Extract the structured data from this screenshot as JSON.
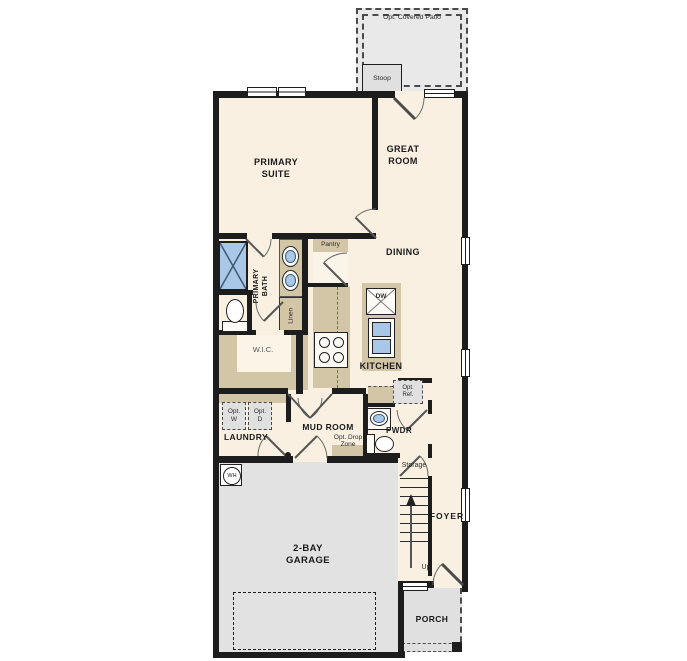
{
  "plan": {
    "labels": {
      "opt_covered_patio": "Opt. Covered Patio",
      "stoop": "Stoop",
      "primary_suite": "PRIMARY\nSUITE",
      "great_room": "GREAT\nROOM",
      "dining": "DINING",
      "kitchen": "KITCHEN",
      "pantry": "Pantry",
      "primary_bath": "PRIMARY\nBATH",
      "linen": "Linen",
      "wic": "W.I.C.",
      "laundry": "LAUNDRY",
      "opt_washer": "Opt.\nW",
      "opt_dryer": "Opt.\nD",
      "mud_room": "MUD ROOM",
      "opt_drop_zone": "Opt. Drop\nZone",
      "opt_ref": "Opt.\nRef.",
      "pwdr": "PWDR",
      "storage": "Storage",
      "foyer": "FOYER",
      "up": "Up",
      "garage": "2-BAY\nGARAGE",
      "water_heater": "WH",
      "dishwasher": "DW",
      "porch": "PORCH"
    },
    "colors": {
      "floor": "#f9f0e2",
      "wall": "#1d1d1d",
      "cabinetry": "#d3c6a6",
      "garage_floor": "#e2e2e2",
      "outdoor": "#e9e9e9",
      "fixture_blue": "#a9c7e6"
    }
  }
}
